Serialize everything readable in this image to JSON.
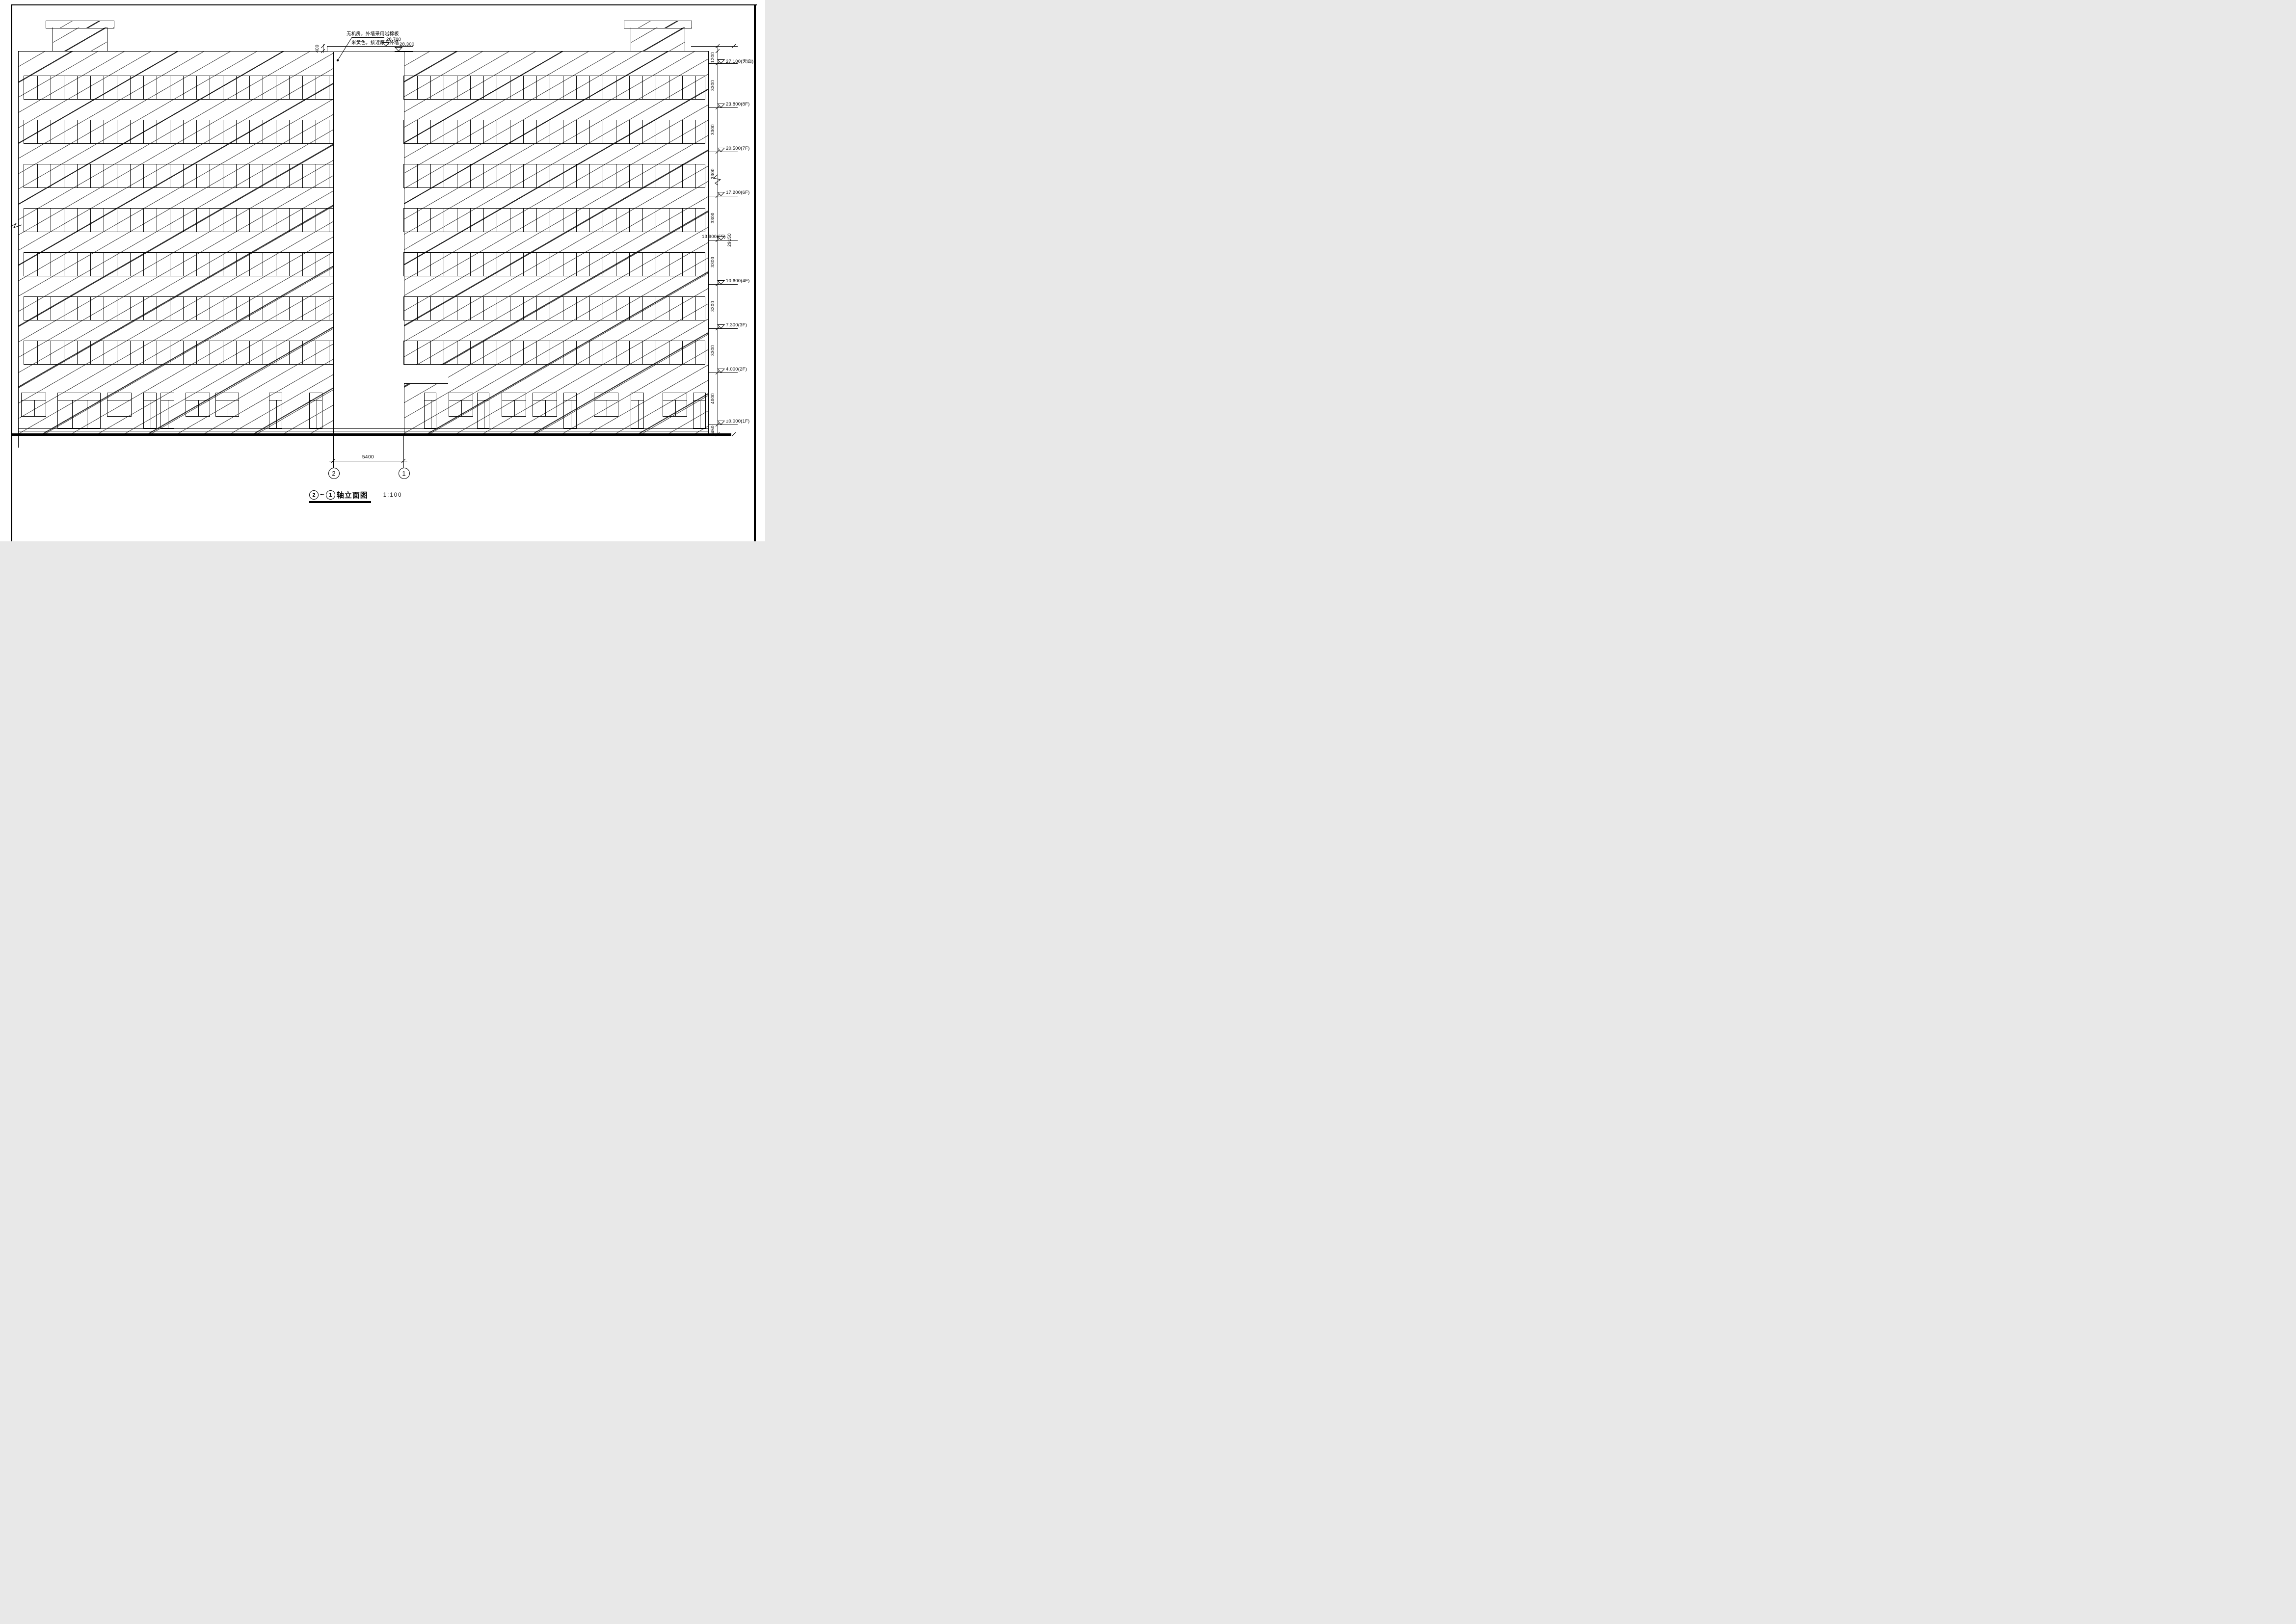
{
  "drawing": {
    "annotation": {
      "line1": "无机房，外墙采用岩棉板",
      "line2": "米黄色，接近原有外墙"
    },
    "top_levels": [
      {
        "value": "28.700"
      },
      {
        "value": "28.300"
      }
    ],
    "parapet_dim": "400",
    "levels": [
      {
        "value": "27.100",
        "floor": "(天面)"
      },
      {
        "value": "23.800",
        "floor": "(8F)"
      },
      {
        "value": "20.500",
        "floor": "(7F)"
      },
      {
        "value": "17.200",
        "floor": "(6F)"
      },
      {
        "value": "13.900",
        "floor": "(5F)"
      },
      {
        "value": "10.600",
        "floor": "(4F)"
      },
      {
        "value": "7.300",
        "floor": "(3F)"
      },
      {
        "value": "4.000",
        "floor": "(2F)"
      },
      {
        "value": "±0.000",
        "floor": "(1F)"
      }
    ],
    "floor_dims": [
      "1200",
      "3300",
      "3300",
      "3300",
      "3300",
      "3300",
      "3300",
      "3300",
      "4000",
      "450"
    ],
    "overall_dim": "29150",
    "axis_span_dim": "5400",
    "axes": [
      {
        "label": "2"
      },
      {
        "label": "1"
      }
    ],
    "title": {
      "axis_from": "2",
      "tilde": "~",
      "axis_to": "1",
      "text": "轴立面图",
      "scale": "1:100"
    }
  }
}
